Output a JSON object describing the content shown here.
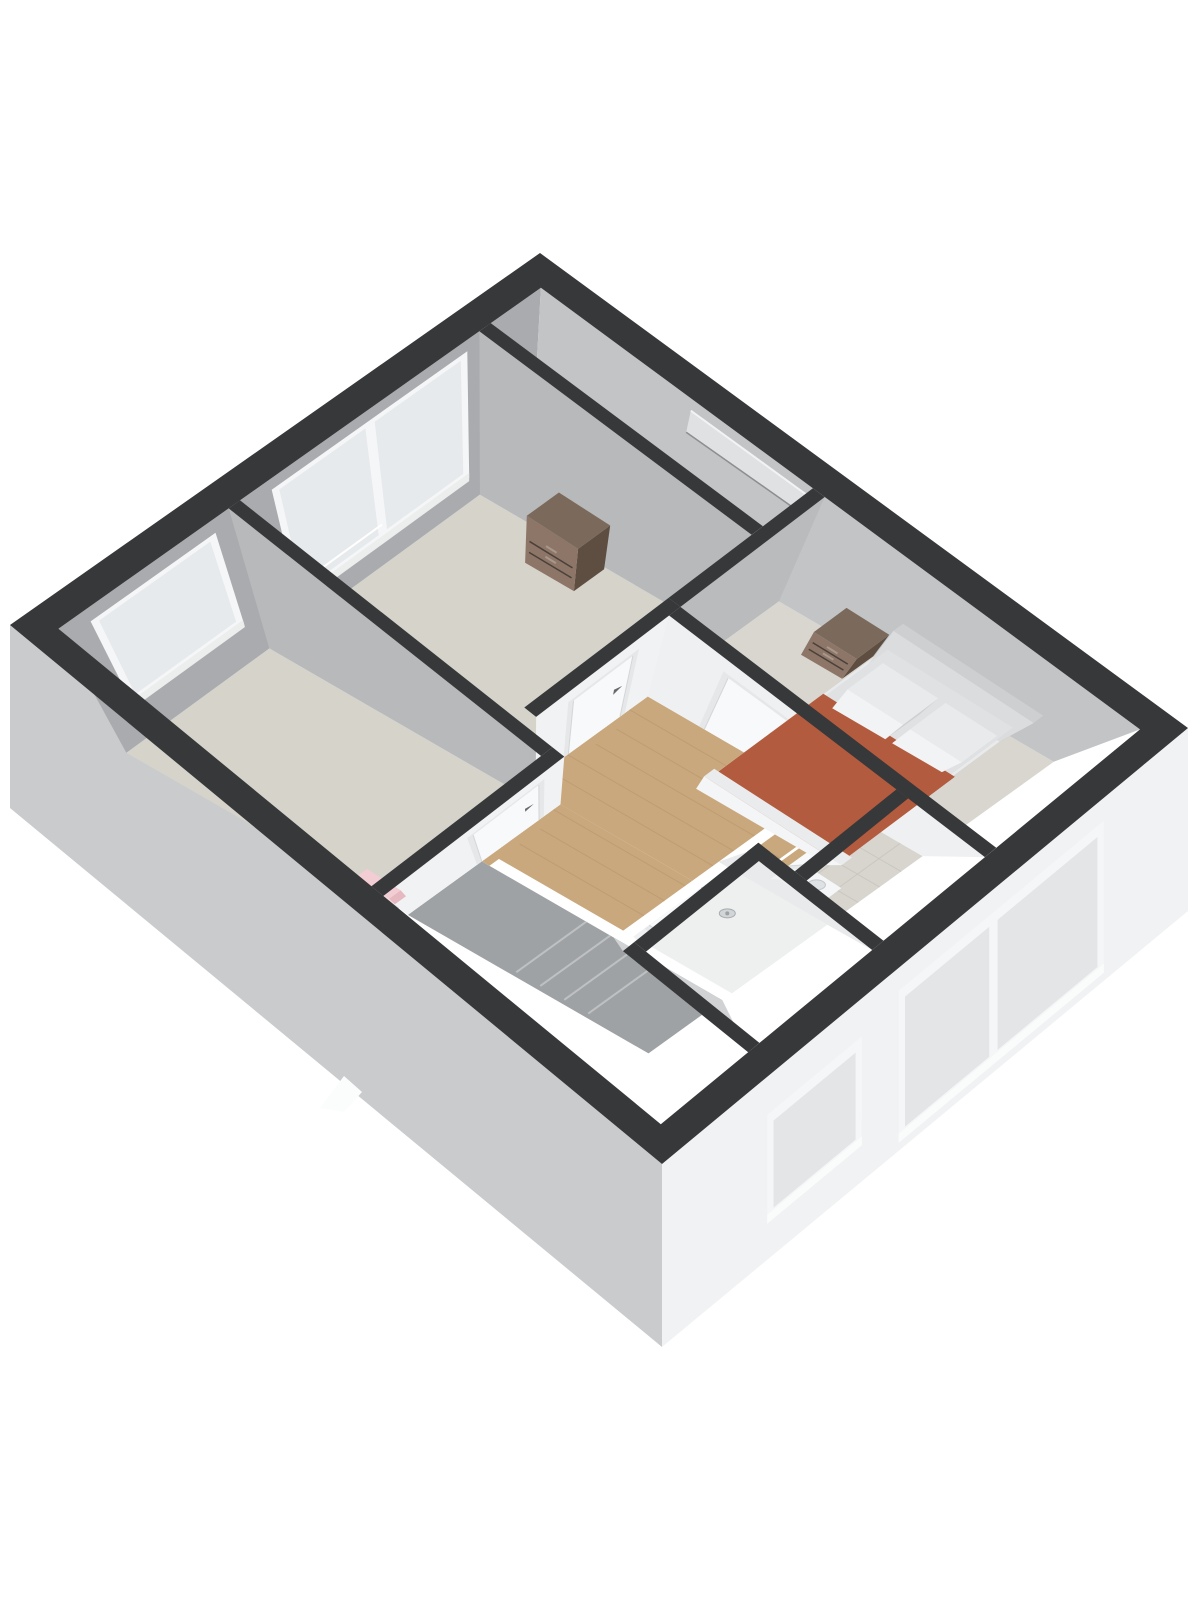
{
  "meta": {
    "title": "3D isometric floor plan render (upper floor with three bedrooms, landing, shower room and toilet)"
  },
  "canvas": {
    "w": 1200,
    "h": 1600,
    "bg": "#ffffff"
  },
  "palette": {
    "wall_top_band": "#37383a",
    "exterior_face_left": "#c9cbcd",
    "exterior_face_right": "#f1f2f3",
    "ext_interior_face_back": "#a9abae",
    "ext_interior_face_right": "#c2c4c6",
    "interior_face_lit": "#f1f2f3",
    "interior_face_shadow": "#b7b9bb",
    "carpet": "#d6d3cb",
    "carpet_bedroom": "#d9d6d0",
    "wood_floor": "#c9a87d",
    "wood_seam": "#b8946b",
    "tile_floor": "#d8d5cf",
    "tile_seam": "#c7c4be",
    "shower_tray": "#eef0f0",
    "door_leaf": "#f8f9fa",
    "door_frame": "#e6e7e9",
    "door_handle": "#67696c",
    "glass": "#e7eaec",
    "window_frame": "#f5f6f7",
    "blanket_terracotta": "#b35b3f",
    "bedding_white": "#e9eaec",
    "furniture_wood_top": "#7b6a5c",
    "furniture_wood_light": "#8d7668",
    "furniture_wood_dark": "#5e4e42",
    "radiator_pink": "#f2cdd3",
    "chrome": "#b4b7ba",
    "sanitary_white": "#f4f6f7",
    "stair_void": "#9fa2a4"
  },
  "calibration": {
    "plan": [
      560,
      660
    ],
    "band": [
      [
        10,
        625
      ],
      [
        540,
        253
      ],
      [
        662,
        1164
      ],
      [
        1188,
        728
      ]
    ],
    "floor": [
      [
        85,
        755
      ],
      [
        530,
        430
      ],
      [
        650,
        1080
      ],
      [
        1095,
        760
      ]
    ],
    "wallDrop": 183
  },
  "exterior": {
    "stair_peek": [
      [
        320,
        1108
      ],
      [
        344,
        1076
      ],
      [
        362,
        1092
      ],
      [
        344,
        1112
      ]
    ],
    "windows": [
      {
        "name": "window-toilet-exterior",
        "f": [
          0.2,
          0.38
        ],
        "top": 45,
        "bot": 140,
        "mullion": null
      },
      {
        "name": "window-bedroom-right-exterior",
        "f": [
          0.45,
          0.84
        ],
        "top": 30,
        "bot": 168,
        "mullion": 0.63
      }
    ]
  },
  "interior": {
    "floors": [
      {
        "name": "floor-bedroom-left",
        "rect": [
          25,
          25,
          205,
          342
        ],
        "fill": "#d6d3cb",
        "kind": "plain"
      },
      {
        "name": "floor-bedroom-back",
        "rect": [
          229,
          25,
          470,
          302
        ],
        "fill": "#d6d3cb",
        "kind": "plain"
      },
      {
        "name": "floor-closet-strip",
        "rect": [
          482,
          25,
          535,
          302
        ],
        "fill": "#cfccc5",
        "kind": "plain"
      },
      {
        "name": "floor-bedroom-right",
        "rect": [
          382,
          314,
          535,
          635
        ],
        "fill": "#d9d6d0",
        "kind": "plain"
      },
      {
        "name": "floor-landing-main",
        "rect": [
          217,
          314,
          370,
          508
        ],
        "fill": "#c9a87d",
        "kind": "wood"
      },
      {
        "name": "floor-landing-left",
        "rect": [
          130,
          354,
          217,
          508
        ],
        "fill": "#c9a87d",
        "kind": "wood"
      },
      {
        "name": "floor-landing-lower",
        "rect": [
          262,
          520,
          370,
          545
        ],
        "fill": "#c9a87d",
        "kind": "wood"
      },
      {
        "name": "floor-stair-void",
        "rect": [
          25,
          354,
          118,
          635
        ],
        "fill": "#9fa2a4",
        "kind": "steps"
      },
      {
        "name": "floor-shower-room",
        "rect": [
          130,
          520,
          250,
          635
        ],
        "fill": "#eef0f0",
        "kind": "plain"
      },
      {
        "name": "floor-toilet",
        "rect": [
          262,
          557,
          370,
          635
        ],
        "fill": "#d8d5cf",
        "kind": "tile"
      }
    ],
    "ext_faces": [
      {
        "name": "wall-face-back-interior",
        "plane": "v25",
        "fill": "#a9abae"
      },
      {
        "name": "wall-face-right-interior",
        "plane": "u535",
        "fill": "#c2c4c6"
      }
    ],
    "windows": [
      {
        "name": "window-bedroom-left",
        "plane": "v25",
        "a": [
          60,
          180
        ],
        "h": [
          0.3,
          0.88
        ],
        "mullion": null
      },
      {
        "name": "window-bedroom-back",
        "plane": "v25",
        "a": [
          255,
          450
        ],
        "h": [
          0.2,
          0.9
        ],
        "mullion": 0.5
      },
      {
        "name": "window-slit-landing",
        "plane": "u535",
        "a": [
          180,
          300
        ],
        "h": [
          0.76,
          0.92
        ],
        "slit": true
      }
    ],
    "walls": [
      {
        "name": "wall-bedroom-left-east",
        "rect": [
          205,
          25,
          217,
          342
        ],
        "face": "w",
        "color": "#b7b9bb"
      },
      {
        "name": "wall-bedroom-back-east",
        "rect": [
          470,
          25,
          482,
          302
        ],
        "face": "w",
        "color": "#b7b9bb"
      },
      {
        "name": "wall-bedroom-right-north",
        "rect": [
          382,
          302,
          535,
          314
        ],
        "face": "s",
        "color": "#b9bbbd"
      },
      {
        "name": "wall-bedroom-back-south",
        "rect": [
          229,
          302,
          382,
          314
        ],
        "face": "s",
        "color": "#f1f2f3"
      },
      {
        "name": "wall-bedroom-left-south",
        "rect": [
          25,
          342,
          217,
          354
        ],
        "face": "s",
        "color": "#f1f2f3"
      },
      {
        "name": "wall-bedroom-right-west",
        "rect": [
          370,
          314,
          382,
          635
        ],
        "face": "w",
        "color": "#eff0f1"
      },
      {
        "name": "wall-shower-north",
        "rect": [
          130,
          508,
          262,
          520
        ],
        "face": "s",
        "color": "#f0f1f2"
      },
      {
        "name": "wall-shower-east",
        "rect": [
          250,
          508,
          262,
          635
        ],
        "face": "w",
        "color": "#e9eaeb"
      },
      {
        "name": "wall-toilet-north",
        "rect": [
          262,
          545,
          370,
          557
        ],
        "face": "s",
        "color": "#f1f2f3"
      },
      {
        "name": "wall-shower-west",
        "rect": [
          118,
          508,
          130,
          635
        ],
        "face": "w",
        "color": "#d0d2d4"
      }
    ],
    "thresholds": [
      {
        "name": "threshold-bedroom-back",
        "vf": 314,
        "u": [
          270,
          335
        ]
      },
      {
        "name": "threshold-bedroom-left",
        "vf": 354,
        "u": [
          118,
          190
        ]
      },
      {
        "name": "threshold-toilet",
        "vf": 557,
        "u": [
          285,
          348
        ]
      }
    ],
    "doors": [
      {
        "name": "door-bedroom-back",
        "type": "u",
        "vf": 314,
        "a": [
          270,
          335
        ]
      },
      {
        "name": "door-bedroom-left",
        "type": "u",
        "vf": 354,
        "a": [
          118,
          190
        ]
      },
      {
        "name": "door-bedroom-right",
        "type": "v",
        "uf": 370,
        "a": [
          380,
          452
        ]
      },
      {
        "name": "door-shower-room",
        "type": "u",
        "vf": 520,
        "a": [
          150,
          215
        ]
      },
      {
        "name": "door-toilet",
        "type": "u",
        "vf": 557,
        "a": [
          285,
          348
        ]
      }
    ]
  },
  "furniture": {
    "dresser": {
      "rect": [
        430,
        115,
        468,
        172
      ],
      "h": 0.34,
      "c": {
        "top": "#7b6a5c",
        "w": "#8d7668",
        "s": "#5e4e42"
      }
    },
    "radiator": {
      "rect": [
        28,
        298,
        42,
        336
      ],
      "h": 0.22,
      "c": {
        "top": "#f2cdd3",
        "w": "#f6d8dd",
        "s": "#e6b9c0"
      }
    },
    "nightstand": {
      "rect": [
        496,
        376,
        535,
        424
      ],
      "h": 0.27,
      "c": {
        "top": "#7b6a5c",
        "w": "#8d7668",
        "s": "#5e4e42"
      }
    },
    "bed": {
      "parts": [
        {
          "name": "bed-frame",
          "rect": [
            310,
            430,
            535,
            580
          ],
          "h": 0.16,
          "c": {
            "top": "#e9eaec",
            "w": "#f3f4f5",
            "s": "#c9cbcd"
          }
        },
        {
          "name": "bed-headboard",
          "rect": [
            524,
            428,
            535,
            582
          ],
          "h": 0.44,
          "c": {
            "top": "#cdcfd1",
            "w": "#dbdcde",
            "s": "#abadaf"
          }
        },
        {
          "name": "bed-mattress",
          "rect": [
            318,
            434,
            526,
            576
          ],
          "h": 0.22,
          "c": {
            "top": "#dfe1e3",
            "w": "#edeeef",
            "s": "#c3c5c7"
          }
        },
        {
          "name": "bed-blanket",
          "rect": [
            310,
            432,
            448,
            580
          ],
          "h": 0.26,
          "c": {
            "top": "#b35b3f",
            "w": "#c06e51",
            "s": "#9b4a33"
          }
        },
        {
          "name": "bed-pillow",
          "rect": [
            462,
            444,
            504,
            506
          ],
          "h": 0.3,
          "c": {
            "top": "#e8eaeb",
            "w": "#f2f3f4",
            "s": "#cdcfd1"
          }
        },
        {
          "name": "bed-pillow",
          "rect": [
            462,
            514,
            504,
            572
          ],
          "h": 0.3,
          "c": {
            "top": "#e8eaeb",
            "w": "#f2f3f4",
            "s": "#cdcfd1"
          }
        },
        {
          "name": "bed-footboard",
          "rect": [
            308,
            428,
            320,
            582
          ],
          "h": 0.3,
          "c": {
            "top": "#e9ebec",
            "w": "#f4f5f6",
            "s": "#cfd1d3"
          }
        }
      ]
    },
    "shower": {
      "railU": 232,
      "vf": 520,
      "drain": [
        205,
        560
      ]
    },
    "basin": {
      "rect": [
        266,
        565,
        288,
        600
      ],
      "h": 0.3,
      "c": {
        "top": "#f4f6f7",
        "w": "#eceeef",
        "s": "#dfe1e3"
      }
    }
  }
}
